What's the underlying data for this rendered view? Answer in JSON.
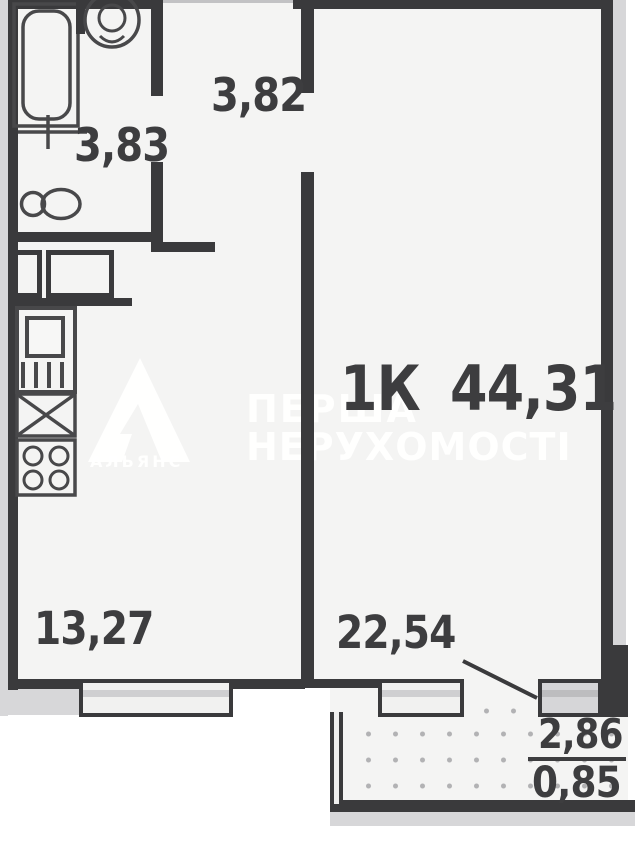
{
  "apartment_label": "1К 44,31",
  "rooms": {
    "hallway": "3,82",
    "bathroom": "3,83",
    "kitchen": "13,27",
    "living": "22,54"
  },
  "balcony": {
    "area": "2,86",
    "area_reduced": "0,85"
  },
  "watermark": {
    "agency_line1": "ПЕРША",
    "agency_line2": "НЕРУХОМОСТІ",
    "logo_caption": "АЛЬЯНС"
  },
  "fixture_icons": [
    "bathtub-icon",
    "washbasin-icon",
    "toilet-icon",
    "kitchen-sink-icon",
    "washing-machine-icon",
    "stove-icon",
    "wardrobe-icon",
    "balcony-door-icon",
    "window-icon"
  ],
  "colors": {
    "wall": "#3a3a3c",
    "room_fill": "#f4f4f3",
    "outside_shadow": "#d7d7d9",
    "watermark": "#ffffff",
    "label_text": "#3d3d3f",
    "balcony_dots": "#b2b2b4"
  }
}
